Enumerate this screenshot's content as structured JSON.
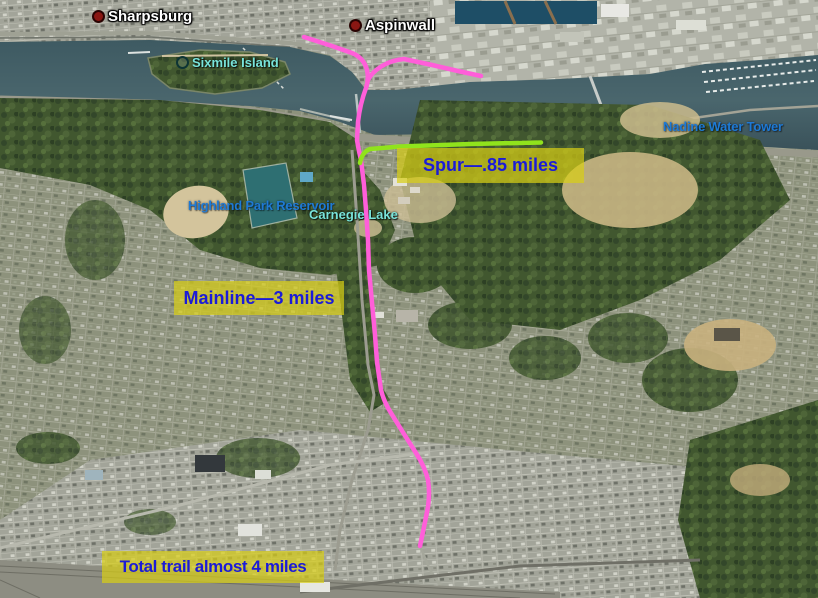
{
  "map": {
    "place_labels": [
      {
        "id": "sharpsburg",
        "text": "Sharpsburg",
        "type": "town"
      },
      {
        "id": "aspinwall",
        "text": "Aspinwall",
        "type": "town"
      },
      {
        "id": "sixmile-island",
        "text": "Sixmile Island",
        "type": "water"
      },
      {
        "id": "nadine-water-tower",
        "text": "Nadine Water Tower",
        "type": "poi"
      },
      {
        "id": "highland-park-reservoir",
        "text": "Highland Park Reservoir",
        "type": "poi"
      },
      {
        "id": "carnegie-lake",
        "text": "Carnegie Lake",
        "type": "water"
      }
    ],
    "annotations": [
      {
        "id": "spur",
        "text": "Spur—.85 miles"
      },
      {
        "id": "mainline",
        "text": "Mainline—3 miles"
      },
      {
        "id": "total",
        "text": "Total trail almost 4 miles"
      }
    ],
    "colors": {
      "trail_pink": "#FF5ED9",
      "spur_green": "#90E31C",
      "note_bg_yellow": "#D8CE14",
      "note_text_blue": "#1B1BD8",
      "town_label_white": "#FFFFFF",
      "water_label_cyan": "#79E4DA",
      "poi_label_blue": "#1E7AD4",
      "marker_red": "#8A1713",
      "river_water": "#46626B"
    }
  }
}
